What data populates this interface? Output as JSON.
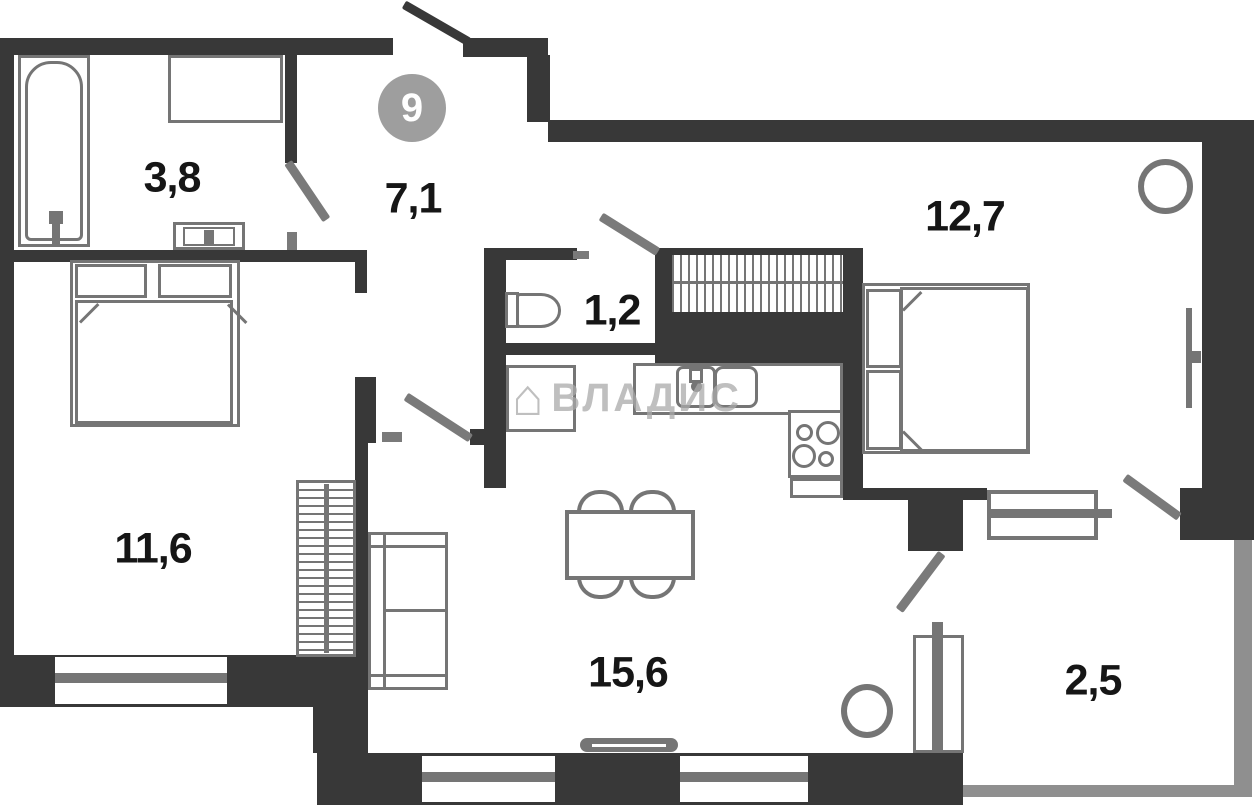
{
  "plan": {
    "unit_badge": "9",
    "watermark": {
      "text": "ВЛАДИС",
      "icon": "house-icon"
    },
    "rooms": [
      {
        "id": "bathroom",
        "area_label": "3,8"
      },
      {
        "id": "hallway",
        "area_label": "7,1"
      },
      {
        "id": "wc",
        "area_label": "1,2"
      },
      {
        "id": "bedroom-top-right",
        "area_label": "12,7"
      },
      {
        "id": "bedroom-left",
        "area_label": "11,6"
      },
      {
        "id": "living-room",
        "area_label": "15,6"
      },
      {
        "id": "balcony",
        "area_label": "2,5"
      }
    ],
    "colors": {
      "wall": "#383838",
      "fixture": "#757575",
      "balcony_wall": "#8f8f8f",
      "badge": "#9e9e9e",
      "watermark": "#aaaaaa",
      "label": "#161616",
      "background": "#ffffff"
    }
  }
}
